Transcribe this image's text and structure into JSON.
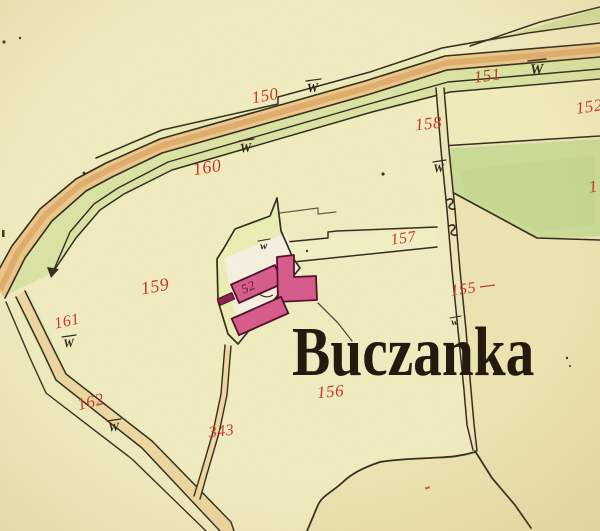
{
  "map": {
    "place_name": "Buczanka",
    "house_number": "52",
    "parcel_labels": {
      "p150": "150",
      "p151": "151",
      "p152": "152",
      "p155": "155",
      "p156": "156",
      "p157": "157",
      "p158": "158",
      "p159": "159",
      "p160": "160",
      "p161": "161",
      "p162": "162",
      "p343": "343",
      "partial_right": "1"
    },
    "symbols": {
      "meadow_large": "W",
      "meadow_small": "w"
    },
    "colors": {
      "paper": "#f2eec2",
      "paper_shade": "#ebdfa9",
      "main_road_fill": "#ecc88c",
      "main_road_core": "#dda663",
      "side_road_fill": "#eed9a4",
      "roadside_meadow_green": "#dbe5a4",
      "field_green": "#cbdd98",
      "building_pink": "#d85a8c",
      "building_dark": "#8c2246",
      "building_outline": "#4d1028",
      "label_red": "#c5382b",
      "ink": "#332a1d",
      "title_ink": "#1f170d",
      "plot_fill": "#ecefb6",
      "yard_white": "#f7f2e2"
    }
  }
}
